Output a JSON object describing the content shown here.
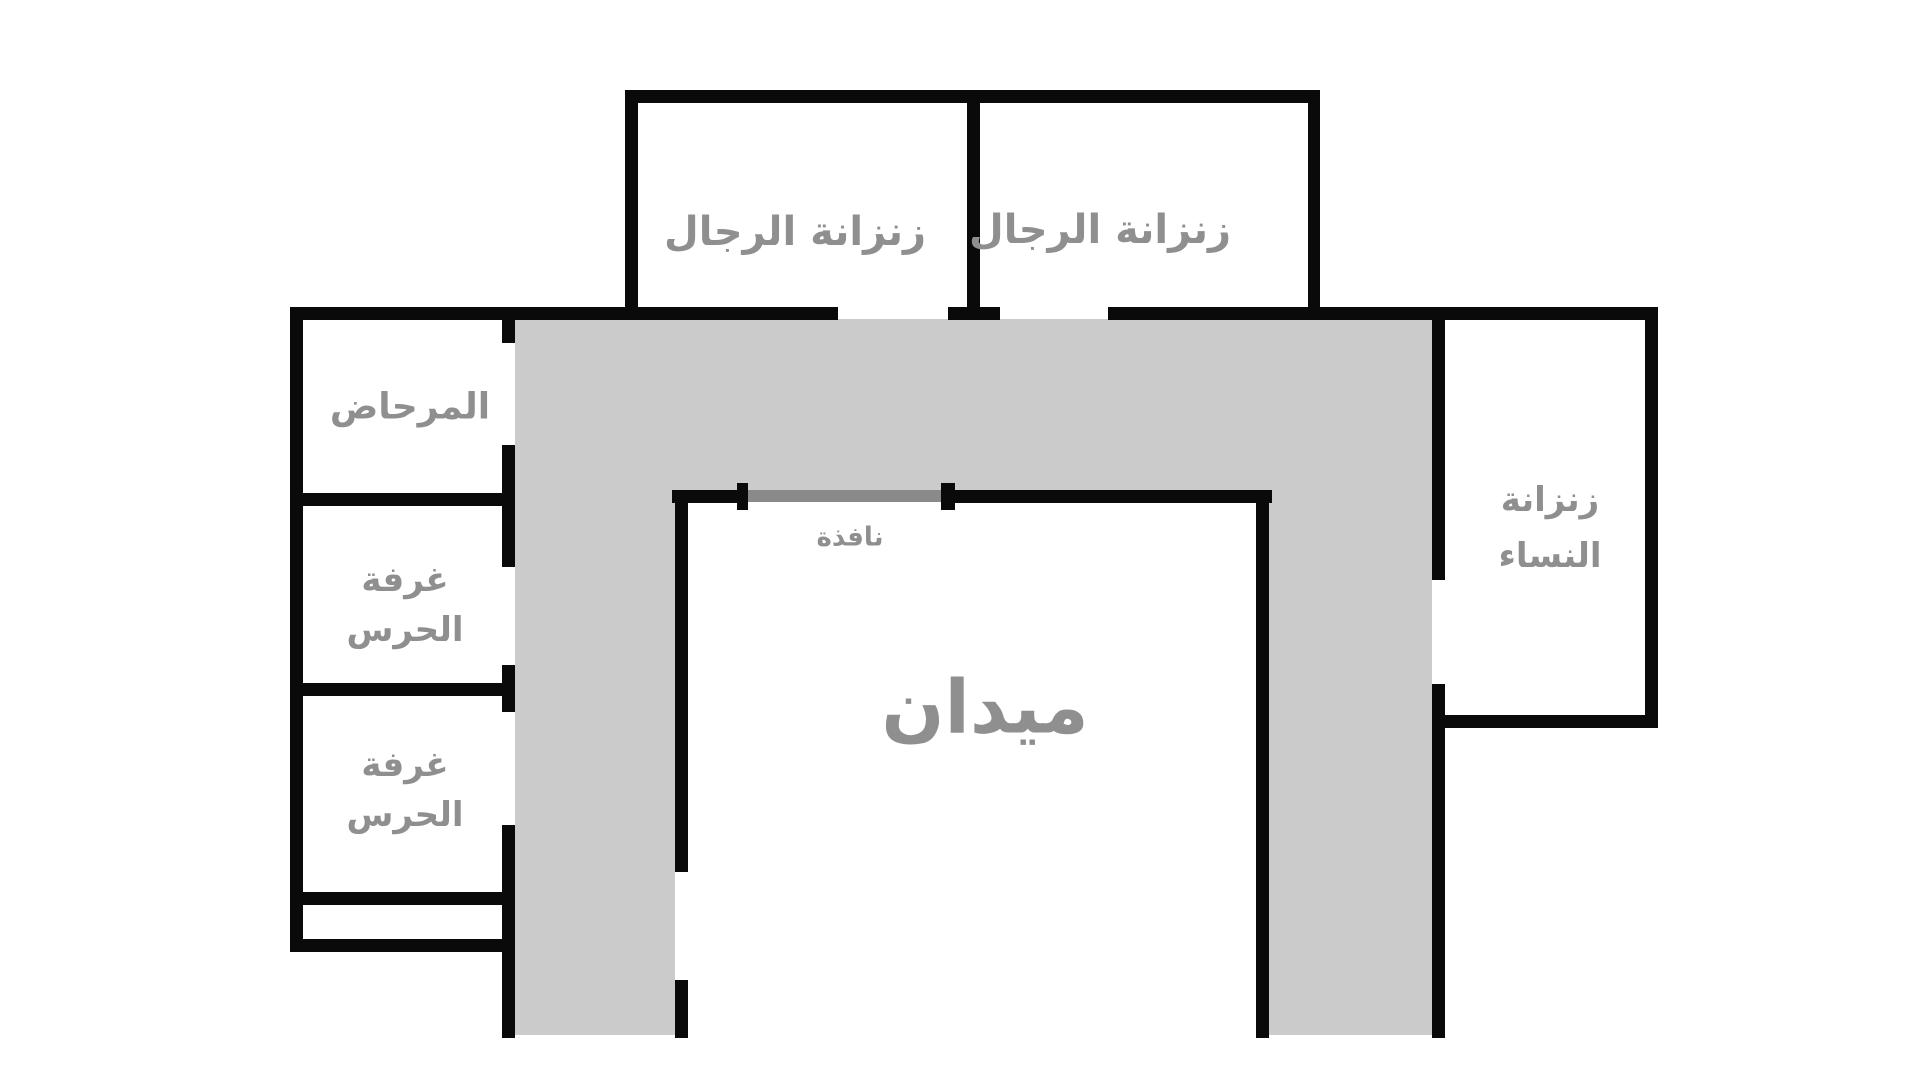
{
  "title": "prison-floor-plan",
  "colors": {
    "wall": "#0a0a0a",
    "corridor_fill": "#cbcbcb",
    "window_bar": "#8a8a8a",
    "label_text": "#8f8f8f",
    "background": "#ffffff"
  },
  "rooms": {
    "mens_cell_left": {
      "label": "زنزانة الرجال"
    },
    "mens_cell_right": {
      "label": "زنزانة الرجال"
    },
    "toilet": {
      "label": "المرحاض"
    },
    "guard_room_1": {
      "line1": "غرفة",
      "line2": "الحرس"
    },
    "guard_room_2": {
      "line1": "غرفة",
      "line2": "الحرس"
    },
    "womens_cell": {
      "line1": "زنزانة",
      "line2": "النساء"
    }
  },
  "courtyard": {
    "label": "ميدان"
  },
  "window": {
    "label": "نافذة"
  }
}
